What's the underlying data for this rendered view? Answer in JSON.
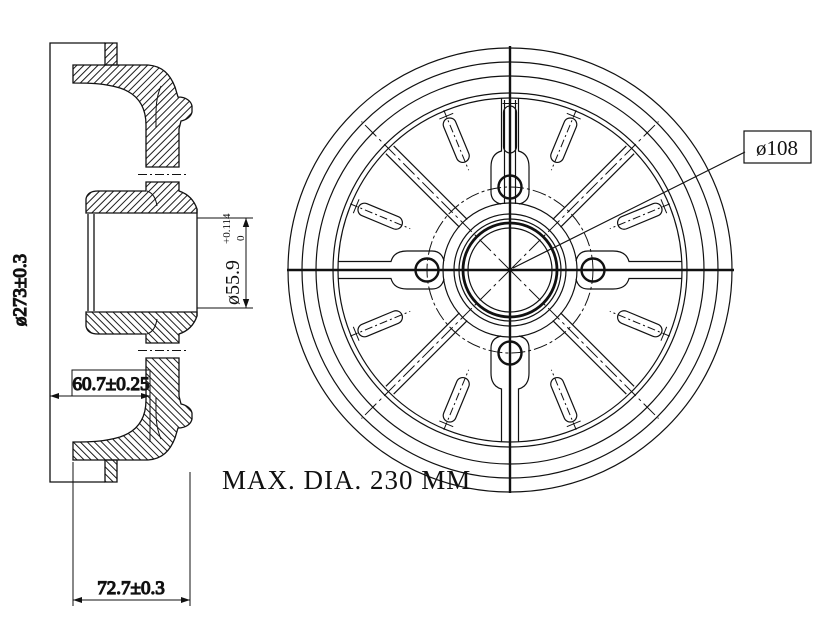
{
  "section_view": {
    "dim_outer_diameter": "ø273±0.3",
    "dim_inner_depth": "60.7±0.25",
    "dim_total_depth": "72.7±0.3",
    "bore": {
      "value": "ø55.9",
      "tolerance_upper": "+0.114",
      "tolerance_lower": "0"
    }
  },
  "front_view": {
    "bolt_circle_diameter": "ø108",
    "max_diameter_note": "MAX. DIA. 230 MM"
  },
  "colors": {
    "line": "#111111",
    "background": "#ffffff"
  }
}
